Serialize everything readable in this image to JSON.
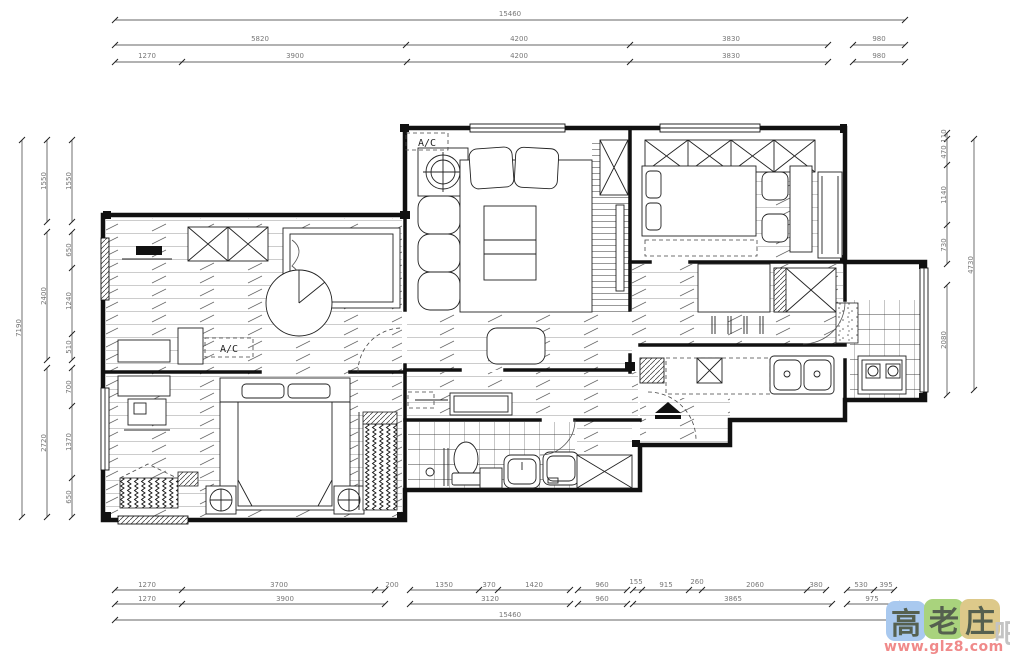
{
  "plan": {
    "ac_label_living": "A/C",
    "ac_label_bedroom": "A/C"
  },
  "dimensions": {
    "top_overall": "15460",
    "top_row2": [
      "5820",
      "4200",
      "3830",
      "980"
    ],
    "top_row3": [
      "1270",
      "3900",
      "4200",
      "3830",
      "980"
    ],
    "left_overall": "7190",
    "left_mid": [
      "1550",
      "2400",
      "2720"
    ],
    "left_inner": [
      "1550",
      "650",
      "1240",
      "510",
      "700",
      "1370",
      "650"
    ],
    "right_overall": "4730",
    "right_inner": [
      "110",
      "470",
      "1140",
      "730",
      "2080"
    ],
    "bottom_row1": [
      "1270",
      "3700",
      "200",
      "1350",
      "370",
      "1420",
      "960",
      "155",
      "915",
      "260",
      "2060",
      "380",
      "530",
      "395"
    ],
    "bottom_row2": [
      "1270",
      "3900",
      "3120",
      "960",
      "3865",
      "975"
    ],
    "bottom_overall": "15460"
  },
  "watermark": {
    "chars": [
      "高",
      "老",
      "庄",
      "吧"
    ],
    "url": "www.glz8.com",
    "tile_colors": [
      "#a9c9ef",
      "#a9d37d",
      "#ddc98a"
    ],
    "text_color": "#f08a8a"
  }
}
